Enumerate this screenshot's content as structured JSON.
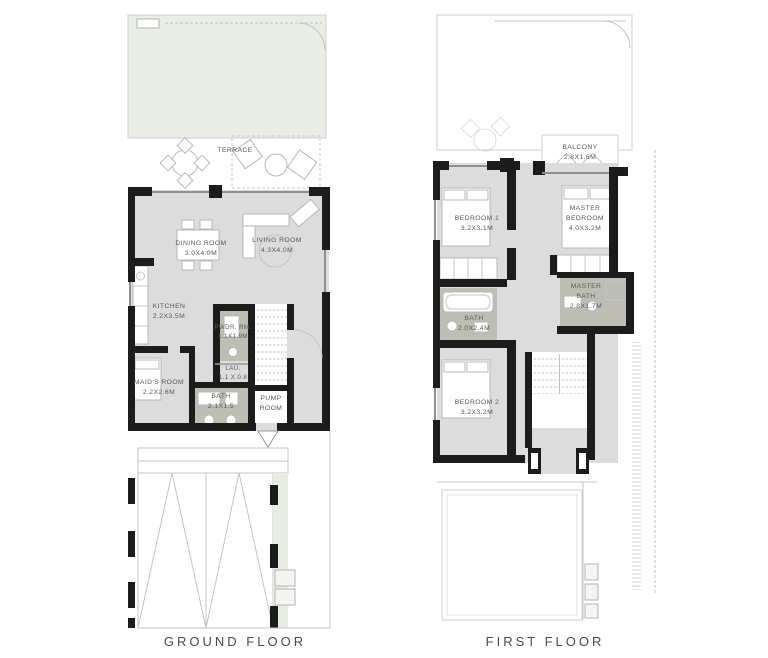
{
  "colors": {
    "wall": "#1c1c1c",
    "floor": "#dcdcdc",
    "wet": "#bdbdb4",
    "garden": "#e9ede6",
    "lawn": "#e6ecdf",
    "line": "#c4c4c4",
    "label": "#5a5a5a",
    "title": "#4a4a4a"
  },
  "ground_floor": {
    "title": "GROUND FLOOR",
    "terrace": "TERRACE",
    "rooms": {
      "dining": {
        "name": "DINING ROOM",
        "dims": "3.0X4.0M"
      },
      "living": {
        "name": "LIVING ROOM",
        "dims": "4.3X4.0M"
      },
      "kitchen": {
        "name": "KITCHEN",
        "dims": "2.2X3.5M"
      },
      "powder": {
        "name": "PWDR. RM.",
        "dims": "1.1X1.9M"
      },
      "laundry": {
        "name": "LAU.",
        "dims": "1.1 X 0.8"
      },
      "maids": {
        "name": "MAID'S ROOM",
        "dims": "2.2X2.6M"
      },
      "bath": {
        "name": "BATH",
        "dims": "2.1X1.5"
      },
      "pump": {
        "name": "PUMP ROOM",
        "dims": ""
      }
    }
  },
  "first_floor": {
    "title": "FIRST FLOOR",
    "rooms": {
      "balcony": {
        "name": "BALCONY",
        "dims": "2.8X1.6M"
      },
      "bedroom1": {
        "name": "BEDROOM 1",
        "dims": "3.2X3.1M"
      },
      "master_bedroom": {
        "name": "MASTER BEDROOM",
        "dims": "4.0X3.2M"
      },
      "master_bath": {
        "name": "MASTER BATH",
        "dims": "2.8X1.7M"
      },
      "bath": {
        "name": "BATH",
        "dims": "2.0X2.4M"
      },
      "bedroom2": {
        "name": "BEDROOM 2",
        "dims": "3.2X3.2M"
      }
    }
  }
}
